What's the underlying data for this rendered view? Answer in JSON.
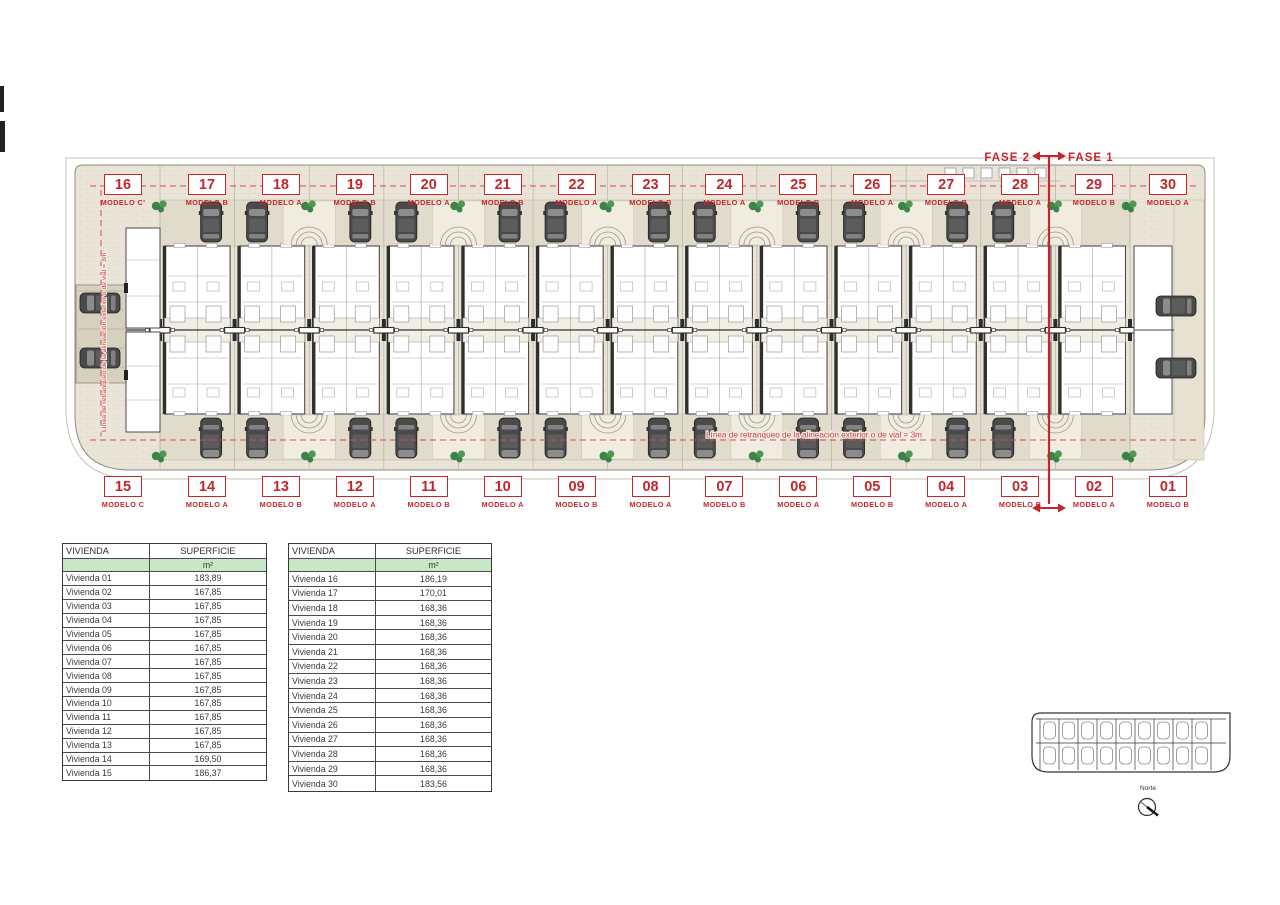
{
  "plan": {
    "fase_labels": {
      "left": "FASE 2",
      "right": "FASE 1"
    },
    "setback_note_h": "Línea de retranqueo de la alineación exterior o de vial = 3m",
    "setback_note_v": "Línea de retranqueo de la alineación exterior o de vial = 3m",
    "top_units": [
      {
        "number": "16",
        "model": "MODELO C'"
      },
      {
        "number": "17",
        "model": "MODELO B"
      },
      {
        "number": "18",
        "model": "MODELO A"
      },
      {
        "number": "19",
        "model": "MODELO B"
      },
      {
        "number": "20",
        "model": "MODELO A"
      },
      {
        "number": "21",
        "model": "MODELO B"
      },
      {
        "number": "22",
        "model": "MODELO A"
      },
      {
        "number": "23",
        "model": "MODELO B"
      },
      {
        "number": "24",
        "model": "MODELO A"
      },
      {
        "number": "25",
        "model": "MODELO B"
      },
      {
        "number": "26",
        "model": "MODELO A"
      },
      {
        "number": "27",
        "model": "MODELO B"
      },
      {
        "number": "28",
        "model": "MODELO A"
      },
      {
        "number": "29",
        "model": "MODELO B"
      },
      {
        "number": "30",
        "model": "MODELO A"
      }
    ],
    "bottom_units": [
      {
        "number": "15",
        "model": "MODELO C"
      },
      {
        "number": "14",
        "model": "MODELO A"
      },
      {
        "number": "13",
        "model": "MODELO B"
      },
      {
        "number": "12",
        "model": "MODELO A"
      },
      {
        "number": "11",
        "model": "MODELO B"
      },
      {
        "number": "10",
        "model": "MODELO A"
      },
      {
        "number": "09",
        "model": "MODELO B"
      },
      {
        "number": "08",
        "model": "MODELO A"
      },
      {
        "number": "07",
        "model": "MODELO B"
      },
      {
        "number": "06",
        "model": "MODELO A"
      },
      {
        "number": "05",
        "model": "MODELO B"
      },
      {
        "number": "04",
        "model": "MODELO A"
      },
      {
        "number": "03",
        "model": "MODELO B"
      },
      {
        "number": "02",
        "model": "MODELO A"
      },
      {
        "number": "01",
        "model": "MODELO B"
      }
    ],
    "colors": {
      "accent_red": "#c5262c",
      "table_green": "#c7e7c7",
      "paving": "#eae5d8"
    }
  },
  "tables": [
    {
      "headers": [
        "VIVIENDA",
        "SUPERFICIE"
      ],
      "unit_row": "m²",
      "rows": [
        [
          "Vivienda 01",
          "183,89"
        ],
        [
          "Vivienda 02",
          "167,85"
        ],
        [
          "Vivienda 03",
          "167,85"
        ],
        [
          "Vivienda 04",
          "167,85"
        ],
        [
          "Vivienda 05",
          "167,85"
        ],
        [
          "Vivienda 06",
          "167,85"
        ],
        [
          "Vivienda 07",
          "167,85"
        ],
        [
          "Vivienda 08",
          "167,85"
        ],
        [
          "Vivienda 09",
          "167,85"
        ],
        [
          "Vivienda 10",
          "167,85"
        ],
        [
          "Vivienda 11",
          "167,85"
        ],
        [
          "Vivienda 12",
          "167,85"
        ],
        [
          "Vivienda 13",
          "167,85"
        ],
        [
          "Vivienda 14",
          "169,50"
        ],
        [
          "Vivienda 15",
          "186,37"
        ]
      ]
    },
    {
      "headers": [
        "VIVIENDA",
        "SUPERFICIE"
      ],
      "unit_row": "m²",
      "rows": [
        [
          "Vivienda 16",
          "186,19"
        ],
        [
          "Vivienda 17",
          "170,01"
        ],
        [
          "Vivienda 18",
          "168,36"
        ],
        [
          "Vivienda 19",
          "168,36"
        ],
        [
          "Vivienda 20",
          "168,36"
        ],
        [
          "Vivienda 21",
          "168,36"
        ],
        [
          "Vivienda 22",
          "168,36"
        ],
        [
          "Vivienda 23",
          "168,36"
        ],
        [
          "Vivienda 24",
          "168,36"
        ],
        [
          "Vivienda 25",
          "168,36"
        ],
        [
          "Vivienda 26",
          "168,36"
        ],
        [
          "Vivienda 27",
          "168,36"
        ],
        [
          "Vivienda 28",
          "168,36"
        ],
        [
          "Vivienda 29",
          "168,36"
        ],
        [
          "Vivienda 30",
          "183,56"
        ]
      ]
    }
  ],
  "keyplan": {
    "north_label": "Norte"
  }
}
